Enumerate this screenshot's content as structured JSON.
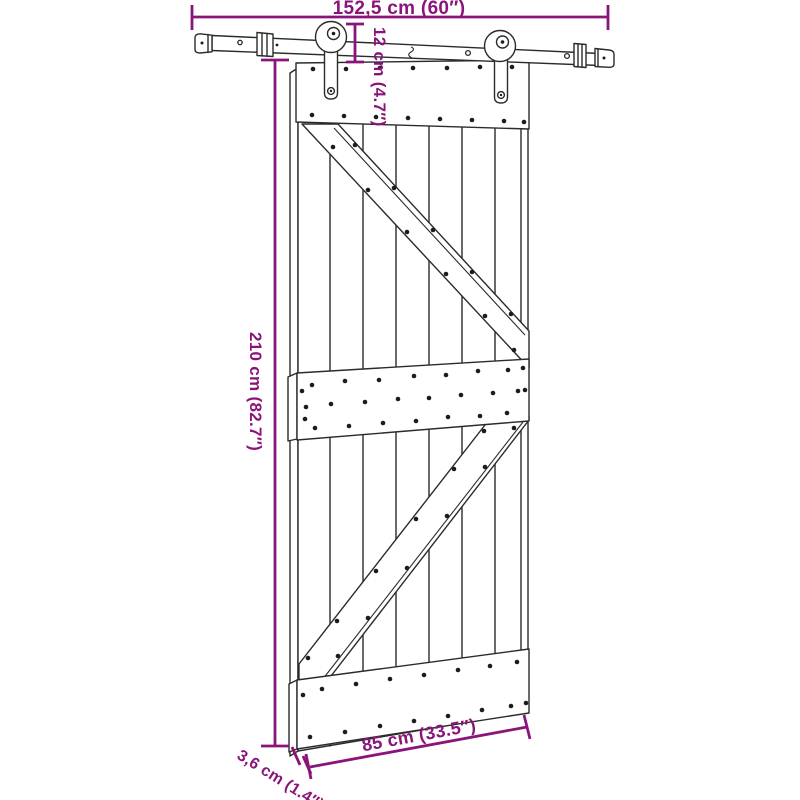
{
  "diagram": {
    "kind": "product-dimension-diagram",
    "dimensions": {
      "rail_length": "152,5 cm (60″)",
      "hanger_drop": "12 cm (4.7″)",
      "door_height": "210 cm (82.7″)",
      "door_thickness": "3,6 cm (1.4″)",
      "door_width": "85 cm (33.5″)"
    },
    "colors": {
      "dimension_annotation": "#8B147A",
      "drawing_outline": "#2B2B2B",
      "screw_dot": "#1C1C1C",
      "background": "#FFFFFF"
    }
  }
}
